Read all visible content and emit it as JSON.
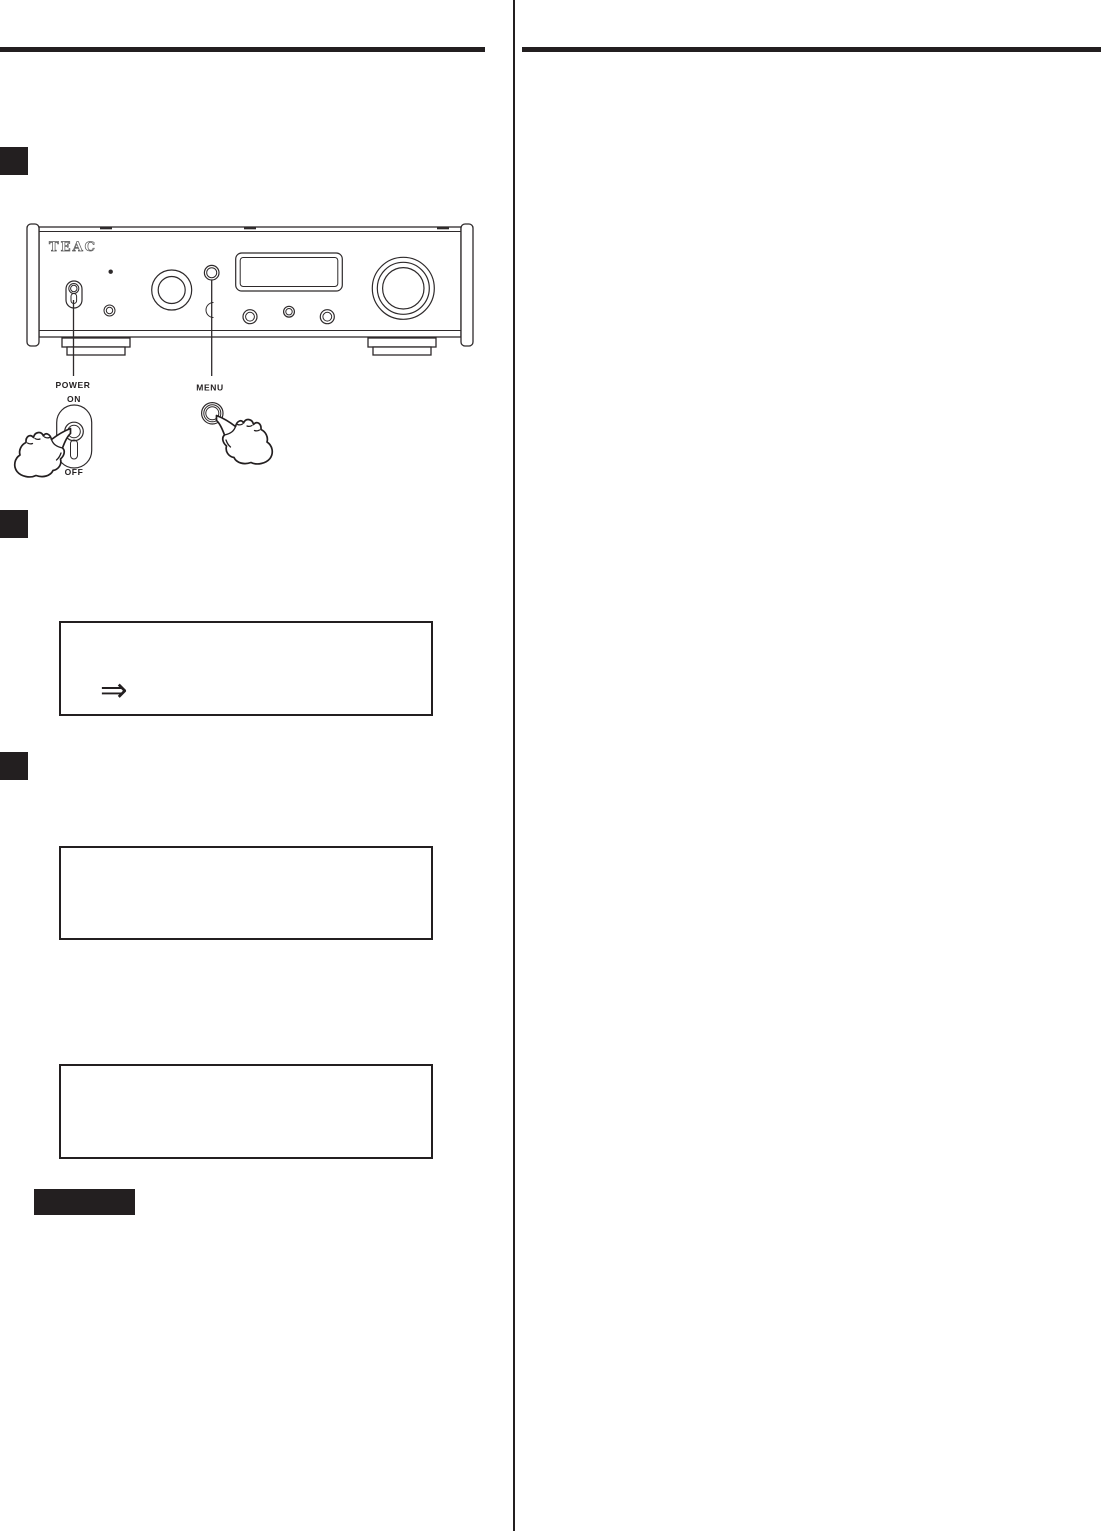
{
  "page": {
    "background": "#ffffff",
    "ink_color": "#231f20"
  },
  "device_panel": {
    "brand_logo": "TEAC"
  },
  "callouts": {
    "power": {
      "label": "POWER",
      "on": "ON",
      "off": "OFF"
    },
    "menu": {
      "label": "MENU"
    }
  },
  "icons": {
    "double_arrow_glyph": "⇒"
  }
}
